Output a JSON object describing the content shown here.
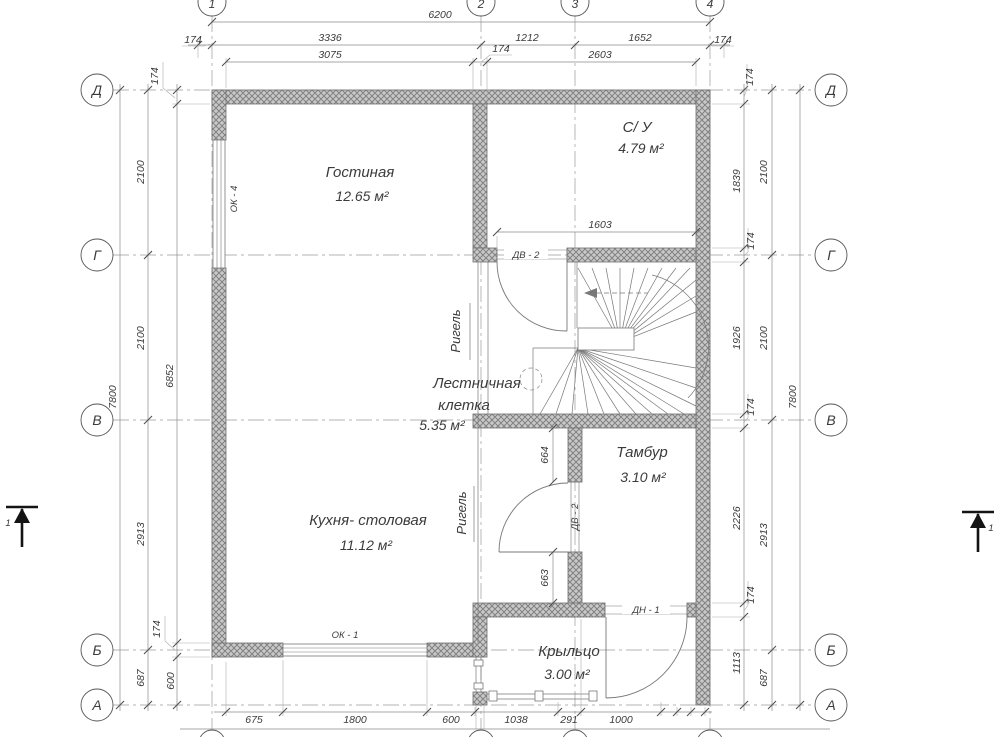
{
  "axes": {
    "col_1": "1",
    "col_2": "2",
    "col_3": "3",
    "col_4": "4",
    "row_d": "Д",
    "row_g": "Г",
    "row_v": "В",
    "row_b": "Б",
    "row_a": "А"
  },
  "rooms": {
    "living": {
      "name": "Гостиная",
      "area": "12.65 м²"
    },
    "bathroom": {
      "name": "С/ У",
      "area": "4.79 м²"
    },
    "stairwell": {
      "name_line1": "Лестничная",
      "name_line2": "клетка",
      "area": "5.35 м²"
    },
    "vestibule": {
      "name": "Тамбур",
      "area": "3.10 м²"
    },
    "kitchen": {
      "name": "Кухня- столовая",
      "area": "11.12 м²"
    },
    "porch": {
      "name": "Крыльцо",
      "area": "3.00 м²"
    }
  },
  "openings": {
    "window_ok4": "ОК - 4",
    "window_ok1": "ОК - 1",
    "door_dv2": "ДВ - 2",
    "door_dn1": "ДН - 1"
  },
  "annotations": {
    "girder": "Ригель",
    "section": "1"
  },
  "dims": {
    "d6200": "6200",
    "d3336": "3336",
    "d1212": "1212",
    "d1652": "1652",
    "d3075": "3075",
    "d2603": "2603",
    "d174": "174",
    "d7800": "7800",
    "d2100": "2100",
    "d6852": "6852",
    "d2913": "2913",
    "d687": "687",
    "d600": "600",
    "d1839": "1839",
    "d1926": "1926",
    "d2226": "2226",
    "d1113": "1113",
    "d675": "675",
    "d1800": "1800",
    "d1038": "1038",
    "d291": "291",
    "d1000": "1000",
    "d1603": "1603",
    "d664": "664",
    "d663": "663"
  }
}
